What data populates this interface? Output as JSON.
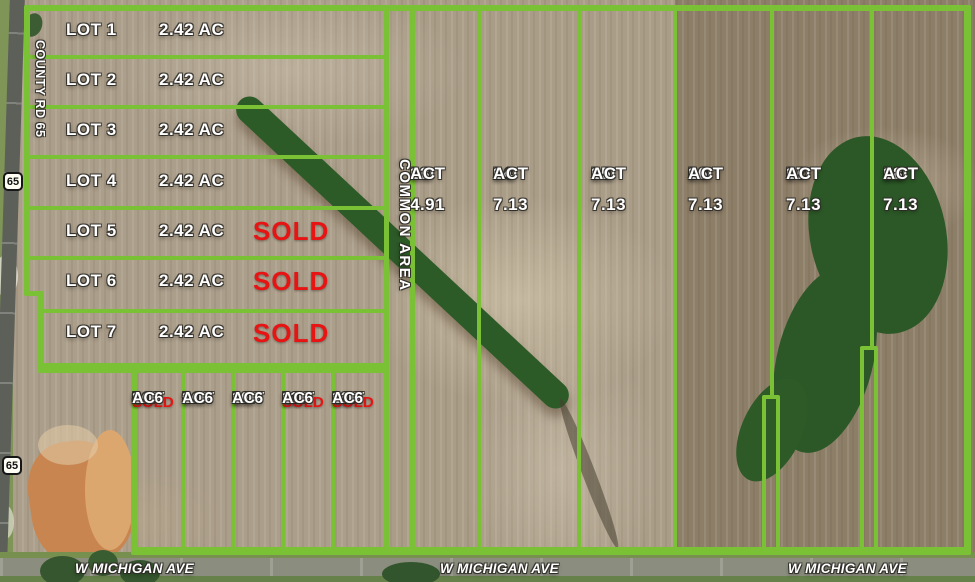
{
  "colors": {
    "boundary_green": "#7bc136",
    "sold_red": "#e81414",
    "label_white": "#ffffff"
  },
  "roads": {
    "county_road_label": "COUNTY RD 65",
    "route_shield": "65",
    "avenue_label": "W MICHIGAN AVE"
  },
  "common_area_label": "COMMON AREA",
  "north_lots": [
    {
      "name": "LOT 1",
      "acreage": "2.42 AC",
      "sold": ""
    },
    {
      "name": "LOT 2",
      "acreage": "2.42 AC",
      "sold": ""
    },
    {
      "name": "LOT 3",
      "acreage": "2.42 AC",
      "sold": ""
    },
    {
      "name": "LOT 4",
      "acreage": "2.42 AC",
      "sold": ""
    },
    {
      "name": "LOT 5",
      "acreage": "2.42 AC",
      "sold": "SOLD"
    },
    {
      "name": "LOT 6",
      "acreage": "2.42 AC",
      "sold": "SOLD"
    },
    {
      "name": "LOT 7",
      "acreage": "2.42 AC",
      "sold": "SOLD"
    }
  ],
  "small_lots": [
    {
      "name": "LOT",
      "number": "8",
      "sold": "SOLD",
      "acre_value": "1.16",
      "acre_unit": "AC"
    },
    {
      "name": "LOT",
      "number": "9",
      "sold": "",
      "acre_value": "1.16",
      "acre_unit": "AC"
    },
    {
      "name": "LOT",
      "number": "10",
      "sold": "",
      "acre_value": "1.16",
      "acre_unit": "AC"
    },
    {
      "name": "LOT",
      "number": "11",
      "sold": "SOLD",
      "acre_value": "1.16",
      "acre_unit": "AC"
    },
    {
      "name": "LOT",
      "number": "12",
      "sold": "SOLD",
      "acre_value": "1.16",
      "acre_unit": "AC"
    }
  ],
  "east_lots": [
    {
      "name": "LOT",
      "number": "13",
      "acre_value": "4.91",
      "acre_unit": "AC"
    },
    {
      "name": "LOT",
      "number": "14",
      "acre_value": "7.13",
      "acre_unit": "AC"
    },
    {
      "name": "LOT",
      "number": "15",
      "acre_value": "7.13",
      "acre_unit": "AC"
    },
    {
      "name": "LOT",
      "number": "16",
      "acre_value": "7.13",
      "acre_unit": "AC"
    },
    {
      "name": "LOT",
      "number": "17",
      "acre_value": "7.13",
      "acre_unit": "AC"
    },
    {
      "name": "LOT",
      "number": "18",
      "acre_value": "7.13",
      "acre_unit": "AC"
    }
  ]
}
